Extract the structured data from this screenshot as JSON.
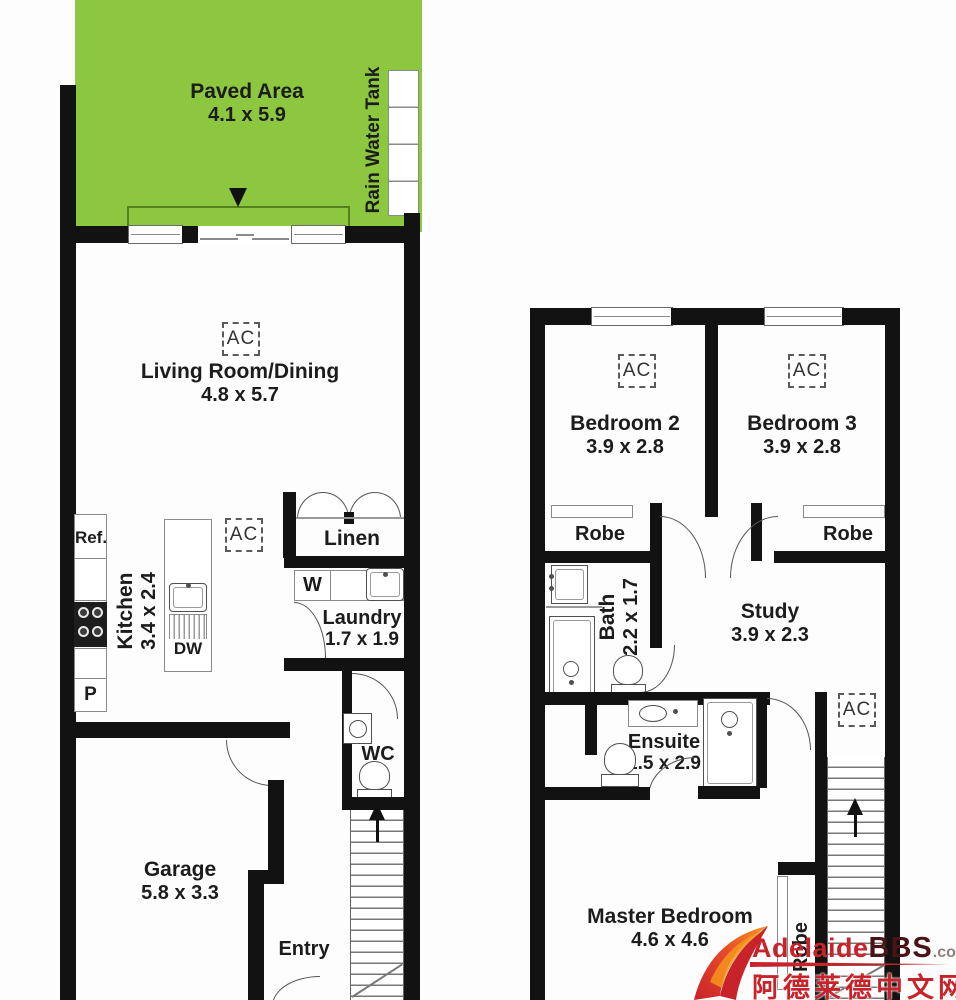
{
  "colors": {
    "paved_green": "#8dc63f",
    "wall_black": "#121212",
    "watermark_red": "#c8232a",
    "watermark_dark_red": "#4a1417",
    "watermark_orange": "#f58220"
  },
  "ac_label": "AC",
  "ground": {
    "paved": {
      "label": "Paved Area",
      "dims": "4.1 x 5.9"
    },
    "rain_water_tank": {
      "label": "Rain Water Tank"
    },
    "living": {
      "label": "Living Room/Dining",
      "dims": "4.8 x 5.7"
    },
    "kitchen": {
      "label": "Kitchen",
      "dims": "3.4 x 2.4"
    },
    "fridge_label": "Ref.",
    "pantry_label": "P",
    "dishwasher_label": "DW",
    "washer_label": "W",
    "linen": {
      "label": "Linen"
    },
    "laundry": {
      "label": "Laundry",
      "dims": "1.7 x 1.9"
    },
    "wc": {
      "label": "WC"
    },
    "garage": {
      "label": "Garage",
      "dims": "5.8 x 3.3"
    },
    "entry": {
      "label": "Entry"
    }
  },
  "upper": {
    "bedroom2": {
      "label": "Bedroom 2",
      "dims": "3.9 x 2.8"
    },
    "bedroom3": {
      "label": "Bedroom 3",
      "dims": "3.9 x 2.8"
    },
    "robe_bed2": {
      "label": "Robe"
    },
    "robe_bed3": {
      "label": "Robe"
    },
    "bath": {
      "label": "Bath",
      "dims": "2.2 x 1.7"
    },
    "study": {
      "label": "Study",
      "dims": "3.9 x 2.3"
    },
    "ensuite": {
      "label": "Ensuite",
      "dims": "1.5 x 2.9"
    },
    "master": {
      "label": "Master Bedroom",
      "dims": "4.6 x 4.6"
    },
    "robe_master": {
      "label": "Robe"
    }
  },
  "watermark": {
    "brand_primary": "Adelaide",
    "brand_secondary": "BBS",
    "brand_tld": ".com",
    "brand_chinese": "阿德莱德中文网"
  }
}
